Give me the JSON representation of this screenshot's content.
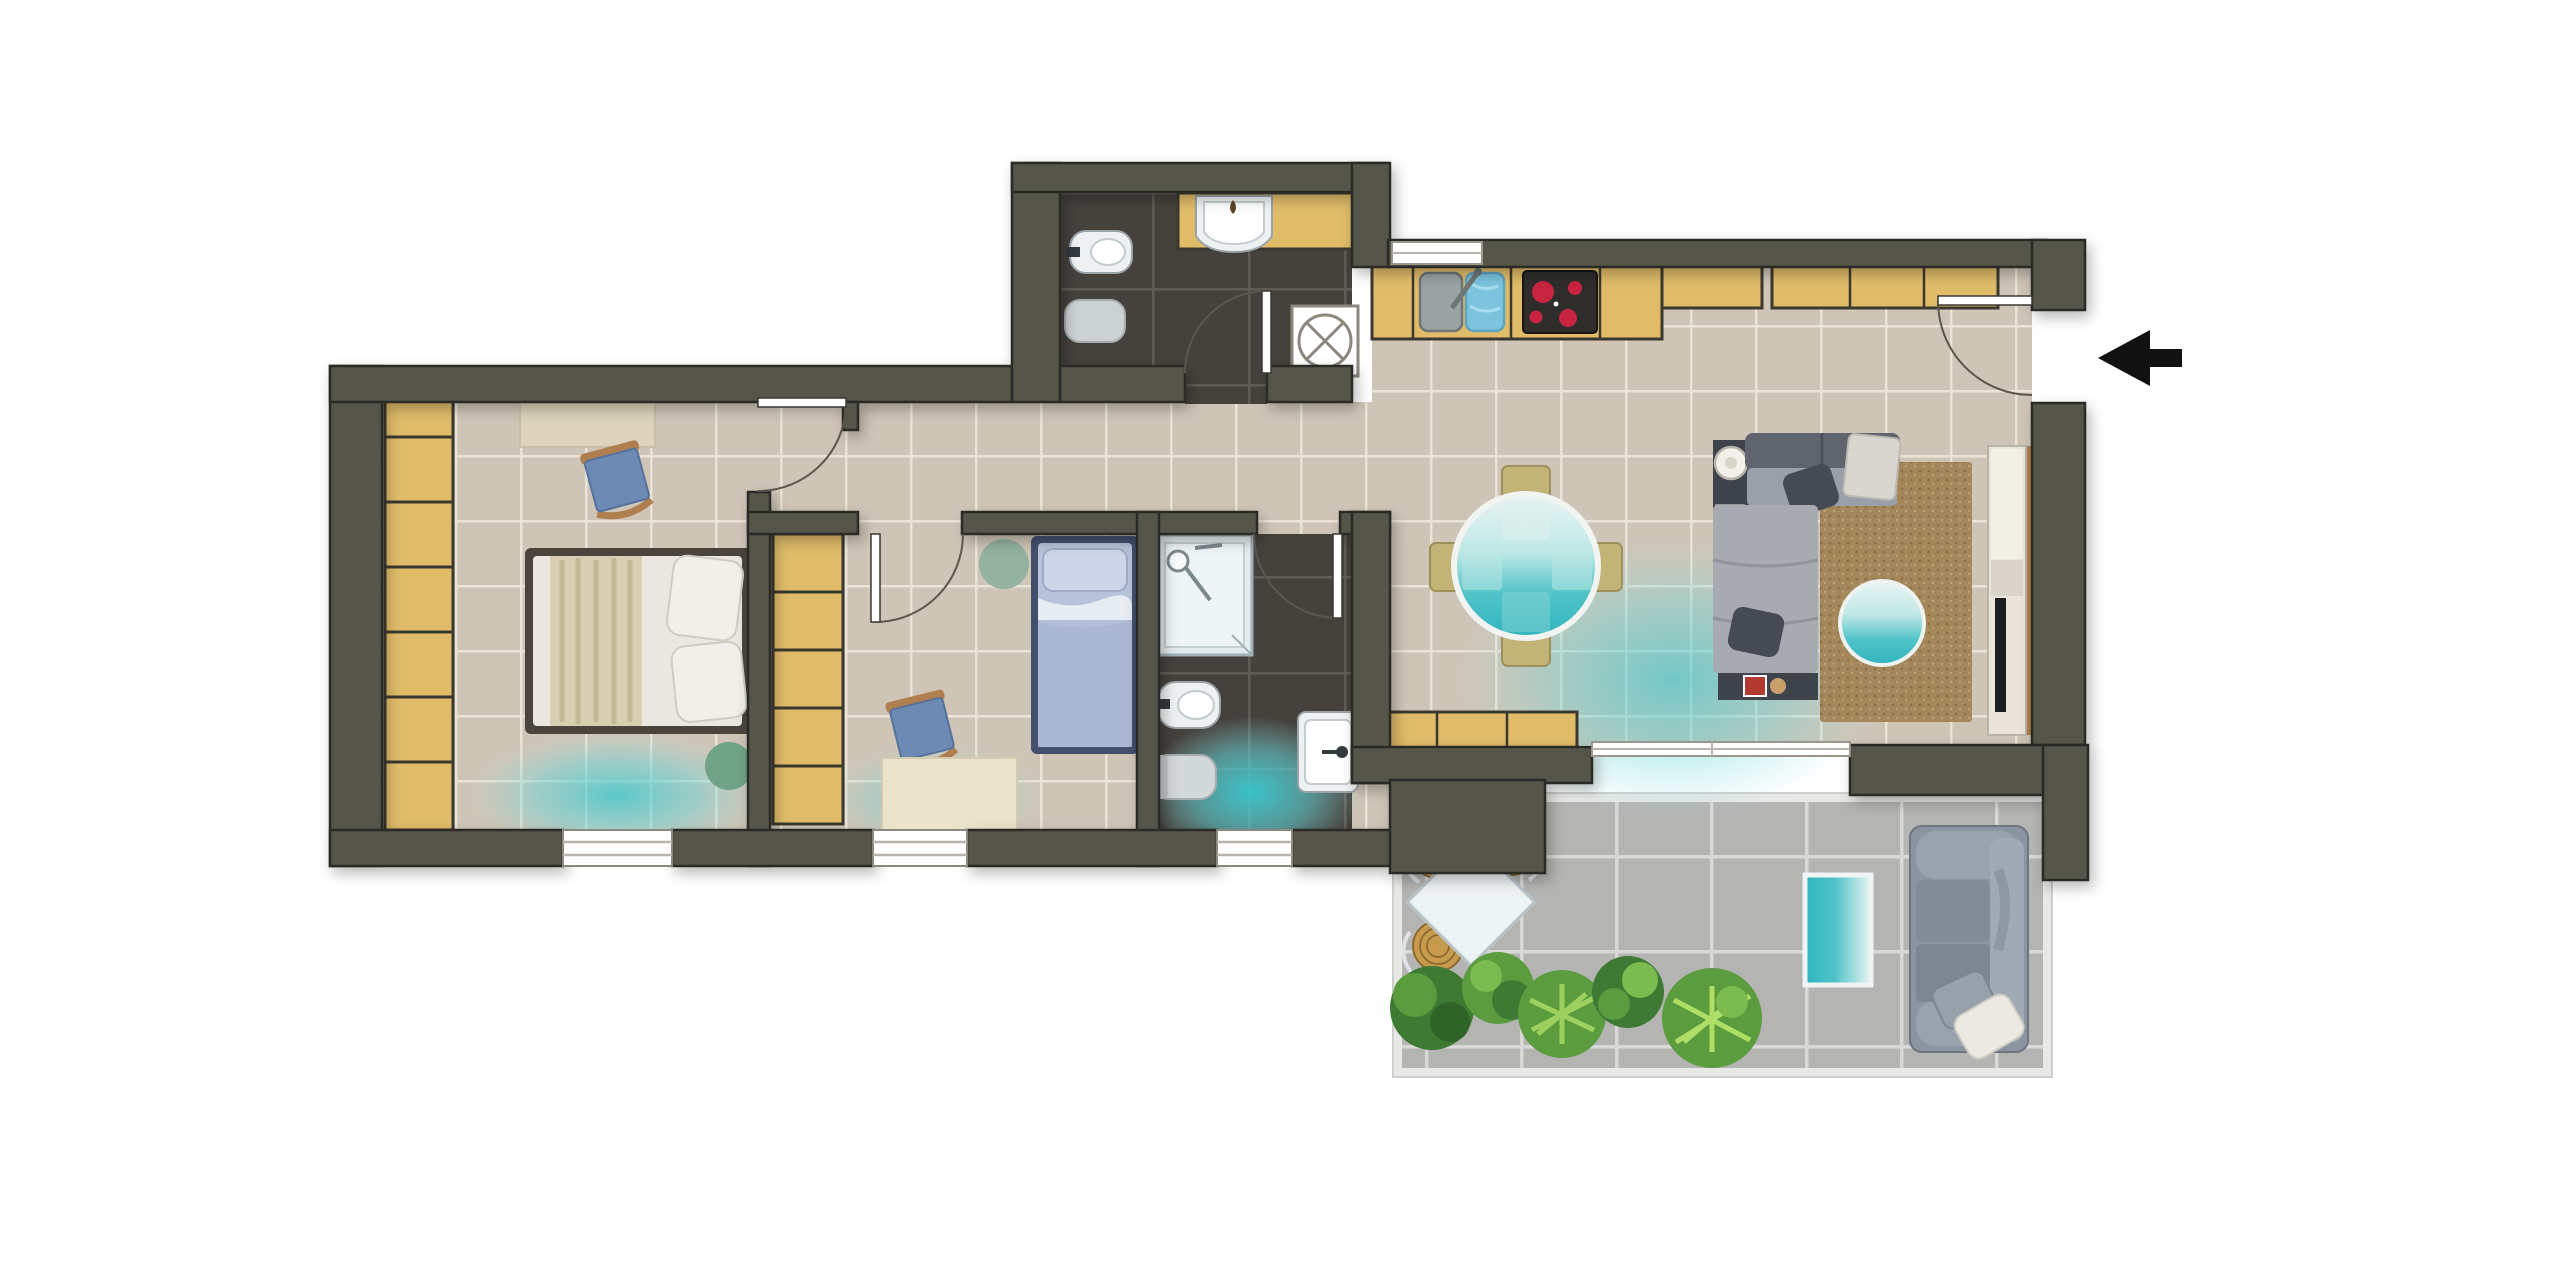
{
  "title": "Apartment floor plan (top view)",
  "entrance": {
    "symbol": "left-arrow",
    "side": "right"
  },
  "colors": {
    "bg": "#ffffff",
    "wall": "#57544a",
    "wallLine": "#2b2a25",
    "floor": "#cfc5b7",
    "grout": "#eae3d7",
    "floorDark": "#45423d",
    "groutDark": "#615c54",
    "terraceFloor": "#b4b4b2",
    "terraceGrout": "#d8d8d6",
    "terraceFrame": "#ffffff",
    "cabinet": "#e0bc69",
    "cabinetLine": "#3b392f",
    "teal": "#3ec6ce",
    "tealSoft": "#8fdfe2",
    "rug": "#a5875c",
    "rugDot": "#8f7148",
    "sofa": "#9aa0aa",
    "sofaDark": "#454a54",
    "bedWhite": "#e9e7e0",
    "blanket": "#d8cfb3",
    "bedBlue": "#b7c3da",
    "bedBlueDark": "#42506e",
    "fixture": "#eef1f2",
    "fixtureLine": "#9aa3a7",
    "pouf": "#6fa287",
    "rugGreen": "#93b2a0",
    "denim": "#6d8ab5",
    "wood": "#b07f4f",
    "plantDark": "#3e7a33",
    "plantMid": "#5a9c3e",
    "plantLight": "#7cbb4f",
    "wicker": "#c79a4e",
    "wickerLine": "#8a6a30",
    "terraceSofa": "#8b95a1",
    "burner": "#c82340",
    "cooktop": "#2e2d2b",
    "arrow": "#111111",
    "doorLeaf": "#ffffff",
    "doorArc": "#5b574c",
    "windowLine": "#b9b4ab"
  },
  "rooms": [
    {
      "name": "bathroom-top",
      "floor": "dark-tile",
      "items": [
        "bidet",
        "toilet",
        "vanity",
        "washbasin",
        "washing-machine"
      ]
    },
    {
      "name": "kitchen",
      "floor": "beige-tile",
      "items": [
        "counter",
        "double-sink",
        "cooktop",
        "upper-cabinet",
        "tall-cabinet"
      ]
    },
    {
      "name": "dining-area",
      "floor": "beige-tile",
      "items": [
        "round-glass-table",
        "chair-north",
        "chair-south",
        "chair-west",
        "chair-east",
        "sideboard"
      ]
    },
    {
      "name": "living-room",
      "floor": "beige-tile",
      "items": [
        "corner-sofa",
        "console",
        "lamp",
        "chaise",
        "rug",
        "round-pouf",
        "tv-unit"
      ]
    },
    {
      "name": "bedroom-master",
      "floor": "beige-tile",
      "items": [
        "wardrobe",
        "bench",
        "chair",
        "double-bed",
        "pouf"
      ]
    },
    {
      "name": "bedroom-second",
      "floor": "beige-tile",
      "items": [
        "wardrobe",
        "round-rug",
        "single-bed",
        "chair",
        "desk"
      ]
    },
    {
      "name": "bathroom-second",
      "floor": "dark-tile",
      "items": [
        "shower",
        "bidet",
        "toilet",
        "washbasin"
      ]
    },
    {
      "name": "terrace",
      "floor": "concrete-tile",
      "items": [
        "wicker-chair",
        "wicker-chair",
        "wicker-chair",
        "square-table",
        "plants",
        "teal-mat",
        "outdoor-sofa"
      ]
    }
  ]
}
